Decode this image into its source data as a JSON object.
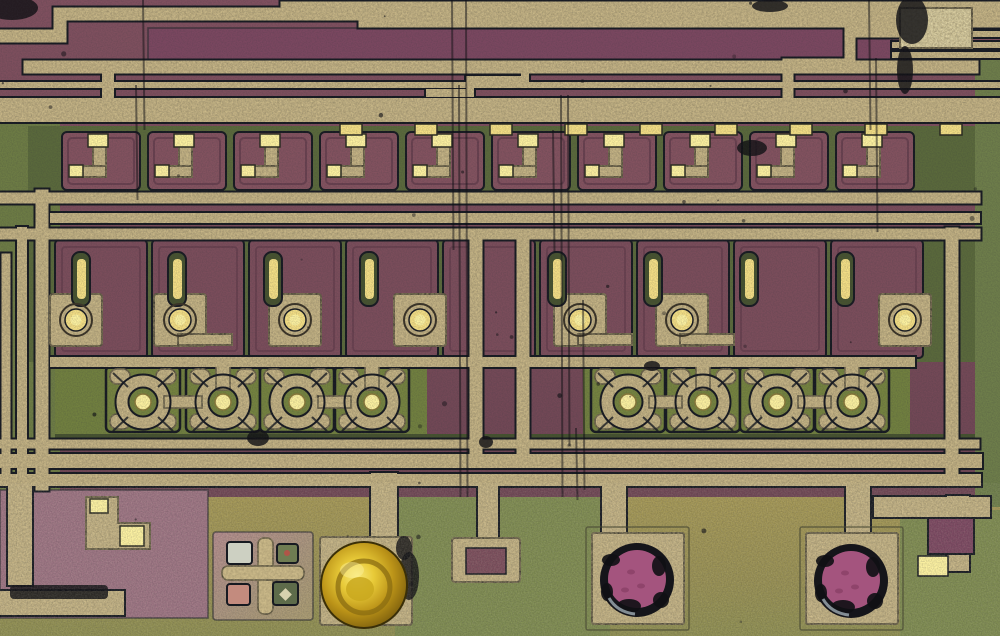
{
  "meta": {
    "title": "Integrated circuit die photograph",
    "description": "Optical microscope photograph of an integrated circuit die: cream speckled metal interconnect traces over purple doped silicon cells and olive-green substrate, a row of circular transistor structures, an alignment cross mark, a gold ball bond, and two damaged bond pads with exposed magenta silicon along the bottom edge."
  },
  "palette": {
    "metal": "#d6c391",
    "metal_bright": "#efe3b2",
    "contact": "#f4df85",
    "contact_bright": "#fdf2a0",
    "maroon": "#7b4d5b",
    "maroon_deep": "#69404f",
    "maroon_light": "#83525f",
    "purple_band": "#7b4760",
    "green_col": "#6d7c44",
    "green_band": "#71803f",
    "green_deep": "#5a693b",
    "green_dark": "#46522f",
    "trans_cell": "#75833f",
    "olive": "#9c9153",
    "olive_green": "#7e8b50",
    "mauve": "#9c7382",
    "dark_line": "#171a21",
    "black": "#101014",
    "gold": "#d9b822",
    "gold_dark": "#8a6c12",
    "gold_light": "#f1d84a",
    "magenta": "#a4547e",
    "silver": "#cdd0c2",
    "pink": "#c38b7e",
    "right_margin": "#6e7e4a",
    "ring_dark": "#3b3427"
  },
  "scene": {
    "regions": [
      {
        "name": "circuit-base",
        "x": 0,
        "y": 0,
        "w": 1000,
        "h": 500,
        "fill": "maroon",
        "grad": "gradBase"
      },
      {
        "name": "top-purple-strip",
        "x": 148,
        "y": 28,
        "w": 744,
        "h": 32,
        "fill": "purple_band",
        "stroke": true
      },
      {
        "name": "left-green-column",
        "x": 0,
        "y": 118,
        "w": 60,
        "h": 380,
        "fill": "green_col"
      },
      {
        "name": "row1-band",
        "x": 28,
        "y": 126,
        "w": 947,
        "h": 74,
        "fill": "green_deep"
      },
      {
        "name": "row2-band",
        "x": 28,
        "y": 238,
        "w": 947,
        "h": 124,
        "fill": "green_deep"
      },
      {
        "name": "transistor-band-left",
        "x": 55,
        "y": 358,
        "w": 372,
        "h": 80,
        "fill": "green_band"
      },
      {
        "name": "transistor-band-right",
        "x": 583,
        "y": 358,
        "w": 327,
        "h": 80,
        "fill": "green_band"
      },
      {
        "name": "dark-strip",
        "x": 55,
        "y": 434,
        "w": 920,
        "h": 12,
        "fill": "green_dark"
      },
      {
        "name": "substrate",
        "x": 0,
        "y": 497,
        "w": 1000,
        "h": 139,
        "fill": "olive",
        "grad": "gradSub"
      },
      {
        "name": "substrate-green-patch",
        "x": 395,
        "y": 497,
        "w": 215,
        "h": 139,
        "fill": "olive_green"
      },
      {
        "name": "substrate-green-right",
        "x": 900,
        "y": 510,
        "w": 100,
        "h": 126,
        "fill": "olive_green"
      },
      {
        "name": "right-margin",
        "x": 975,
        "y": 55,
        "w": 25,
        "h": 452,
        "fill": "right_margin"
      },
      {
        "name": "mauve-block",
        "x": 0,
        "y": 490,
        "w": 208,
        "h": 128,
        "fill": "mauve",
        "stroke": true
      },
      {
        "name": "cross-block",
        "x": 213,
        "y": 532,
        "w": 100,
        "h": 88,
        "fill": "mauve",
        "grad": "gradCross",
        "stroke": true,
        "rx": 3
      }
    ],
    "traces": [
      {
        "d": "M0 36 H60 V14 H1000",
        "w": 13
      },
      {
        "d": "M284 5 H1000",
        "w": 7
      },
      {
        "d": "M362 24 H1000",
        "w": 7
      },
      {
        "d": "M895 34 H1000",
        "w": 6
      },
      {
        "d": "M895 45 H1000",
        "w": 6
      },
      {
        "d": "M895 55 H1000",
        "w": 6
      },
      {
        "d": "M30 67 H972",
        "w": 13
      },
      {
        "d": "M108 67 V100",
        "w": 12
      },
      {
        "d": "M0 85 H1000",
        "w": 6
      },
      {
        "d": "M0 110 H1000",
        "w": 24
      },
      {
        "d": "M430 93 H470 V80 H525 V68 H590",
        "w": 8
      },
      {
        "d": "M900 32 H850 V64 H788",
        "w": 11
      },
      {
        "d": "M788 64 V110",
        "w": 11
      },
      {
        "d": "M0 198 H975",
        "w": 11
      },
      {
        "d": "M55 218 H975",
        "w": 10
      },
      {
        "d": "M0 234 H975",
        "w": 11
      },
      {
        "d": "M55 362 H910",
        "w": 10
      },
      {
        "d": "M0 444 H975",
        "w": 9
      },
      {
        "d": "M0 461 H975",
        "w": 14
      },
      {
        "d": "M0 480 H975",
        "w": 12
      },
      {
        "d": "M6 480 V258",
        "w": 9
      },
      {
        "d": "M22 484 V232",
        "w": 10
      },
      {
        "d": "M42 484 V196",
        "w": 13
      },
      {
        "d": "M476 452 V236",
        "w": 13
      },
      {
        "d": "M523 452 V236",
        "w": 13
      },
      {
        "d": "M952 478 V234",
        "w": 13
      },
      {
        "d": "M20 497 V573",
        "w": 24
      },
      {
        "d": "M0 603 H112",
        "w": 24
      },
      {
        "d": "M384 540 V486",
        "w": 26
      },
      {
        "d": "M488 538 V487",
        "w": 20
      },
      {
        "d": "M614 533 V488",
        "w": 24
      },
      {
        "d": "M858 533 V488",
        "w": 24
      },
      {
        "d": "M884 507 H980",
        "w": 20
      },
      {
        "d": "M958 507 V560",
        "w": 22
      }
    ],
    "bright_ticks": {
      "y": 124,
      "w": 22,
      "h": 11,
      "xs": [
        340,
        415,
        490,
        565,
        640,
        715,
        790,
        865,
        940
      ]
    },
    "row1": {
      "y": 132,
      "w": 78,
      "h": 58,
      "xs": [
        62,
        148,
        234,
        320,
        406,
        492,
        578,
        664,
        750,
        836
      ]
    },
    "row2": {
      "cells": {
        "y": 240,
        "w": 92,
        "h": 118,
        "xs": [
          55,
          152,
          249,
          346,
          443,
          540,
          637,
          734,
          831
        ]
      },
      "strips": {
        "y": 252,
        "w": 18,
        "h": 54,
        "xs": [
          72,
          168,
          264,
          360,
          548,
          644,
          740,
          836
        ]
      },
      "pads": {
        "cy": 320,
        "size": 52,
        "xs": [
          76,
          180,
          295,
          420,
          580,
          682,
          905
        ]
      },
      "hooks": [
        180,
        580,
        682
      ]
    },
    "transistors": {
      "cy": 402,
      "ring_r": 21,
      "core_r": 8,
      "cell_w": 74,
      "cell_h": 66,
      "groups": [
        [
          143,
          223,
          297,
          372
        ],
        [
          628,
          703,
          777,
          852
        ]
      ]
    },
    "bottom": {
      "hook_block": "M86 497 V549 H150 V523 H118 V497 Z",
      "hook_squares": [
        [
          90,
          499,
          18,
          14
        ],
        [
          120,
          526,
          24,
          20
        ]
      ],
      "hook_blob": [
        10,
        585,
        98,
        14
      ],
      "cross": {
        "x": 213,
        "y": 532,
        "w": 100,
        "h": 88
      },
      "ball": {
        "pad": [
          320,
          537,
          92,
          88
        ],
        "cx": 364,
        "cy": 585,
        "r": 43
      },
      "side_pad": {
        "outer": [
          452,
          538,
          68,
          44
        ],
        "inner": [
          466,
          548,
          40,
          26
        ]
      },
      "top_right_block": [
        900,
        8,
        72,
        40
      ],
      "purple_tab": [
        928,
        518,
        46,
        36
      ],
      "bright_tab": [
        918,
        556,
        30,
        20
      ],
      "damaged_pads": [
        {
          "outline": [
            586,
            527,
            103,
            103
          ],
          "pad": [
            592,
            533,
            92,
            91
          ],
          "cx": 637,
          "cy": 580
        },
        {
          "outline": [
            800,
            527,
            103,
            103
          ],
          "pad": [
            806,
            533,
            92,
            91
          ],
          "cx": 851,
          "cy": 581
        }
      ]
    },
    "marks": {
      "scratches": [
        [
          452,
          0,
          250
        ],
        [
          459,
          85,
          497
        ],
        [
          466,
          0,
          497
        ],
        [
          553,
          130,
          252
        ],
        [
          561,
          95,
          497
        ],
        [
          568,
          95,
          446
        ],
        [
          576,
          428,
          500
        ],
        [
          583,
          300,
          490
        ],
        [
          136,
          85,
          200
        ],
        [
          143,
          0,
          130
        ],
        [
          869,
          0,
          130
        ],
        [
          876,
          58,
          232
        ]
      ],
      "blobs": [
        [
          912,
          20,
          16,
          24
        ],
        [
          770,
          6,
          18,
          6
        ],
        [
          752,
          148,
          15,
          8
        ],
        [
          905,
          70,
          8,
          24
        ],
        [
          258,
          438,
          11,
          8
        ],
        [
          652,
          366,
          8,
          5
        ],
        [
          486,
          442,
          7,
          6
        ],
        [
          12,
          8,
          26,
          12
        ],
        [
          404,
          548,
          8,
          12
        ],
        [
          409,
          576,
          10,
          24
        ]
      ]
    }
  }
}
